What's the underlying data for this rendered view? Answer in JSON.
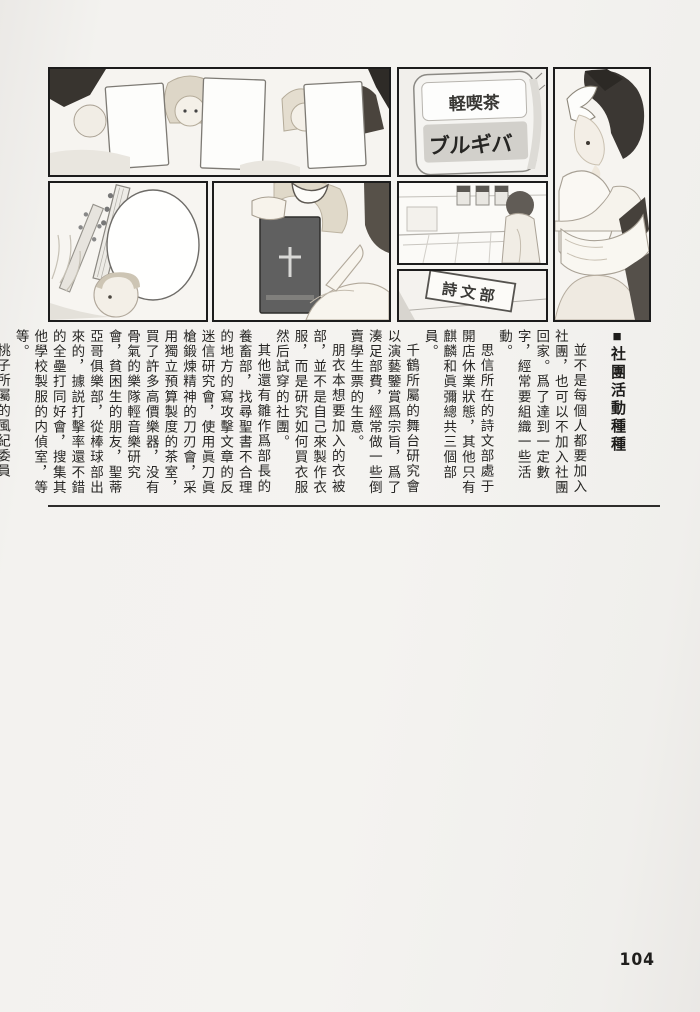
{
  "page": {
    "number": "104"
  },
  "article": {
    "marker": "■",
    "title": "社團活動種種",
    "paragraphs": [
      "並不是每個人都要加入社團，也可以不加入社團回家。爲了達到一定數字，經常要組織一些活動。",
      "思信所在的詩文部處于開店休業狀態，其他只有麒麟和眞彌總共三個部員。",
      "千鶴所屬的舞台研究會以演藝鑒賞爲宗旨，爲了湊足部費，經常做一些倒賣學生票的生意。",
      "朋衣本想要加入的衣被部，並不是自己來製作衣服，而是研究如何買衣服然后試穿的社團。",
      "其他還有雛作爲部長的養畜部，找尋聖書不合理的地方的寫攻擊文章的反迷信研究會，使用眞刀眞槍鍛煉精神的刀刃會，采用獨立預算製度的茶室，買了許多高價樂器，没有骨氣的樂隊輕音樂研究會，貧困生的朋友，聖蒂亞哥俱樂部，從棒球部出來的，據説打擊率還不錯的全壘打同好會，搜集其他學校製服的内偵室，等等。",
      "桃子所屬的風紀委員會，是監督其他社團活動的組織。"
    ]
  },
  "panels": {
    "cafe_sign_line1": "軽喫茶",
    "cafe_sign_logo": "ブルギバ",
    "poetry_sign": "詩文部"
  },
  "colors": {
    "paper": "#f3f2ef",
    "ink": "#272624",
    "panel_border": "#1c1c1c"
  }
}
